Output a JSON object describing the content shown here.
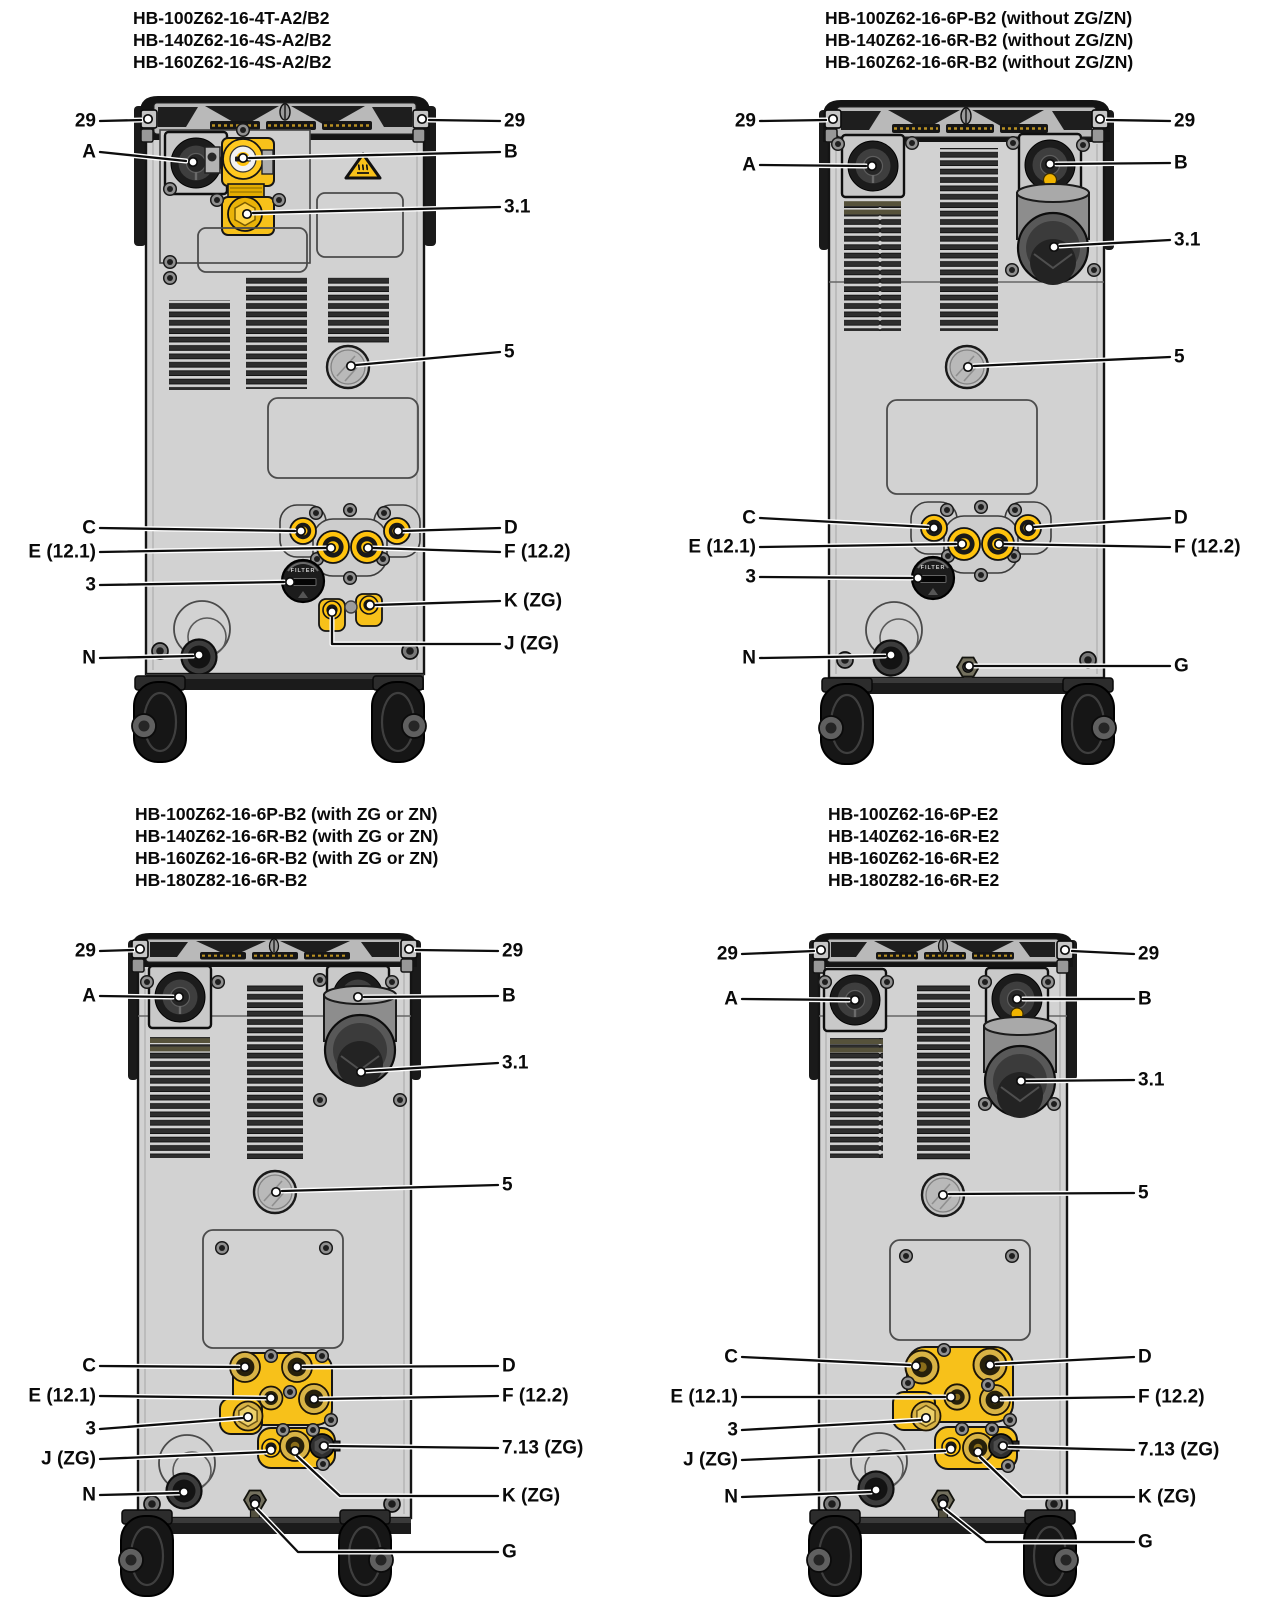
{
  "page": {
    "type": "technical-diagram",
    "background": "#ffffff"
  },
  "shared": {
    "filter_label": "FILTER",
    "colors": {
      "accent_yellow": "#f7c11a",
      "body_gray": "#d2d2d2",
      "outline": "#111111",
      "brass": "#d8b345"
    },
    "icons": {
      "warning": "hot-surface-warning-icon"
    }
  },
  "panels": [
    {
      "id": "top-left",
      "title_lines": [
        "HB-100Z62-16-4T-A2/B2",
        "HB-140Z62-16-4S-A2/B2",
        "HB-160Z62-16-4S-A2/B2"
      ],
      "callouts": {
        "n29l": "29",
        "n29r": "29",
        "a": "A",
        "b": "B",
        "v31": "3.1",
        "v5": "5",
        "c": "C",
        "d": "D",
        "e": "E (12.1)",
        "f": "F (12.2)",
        "v3": "3",
        "k": "K (ZG)",
        "j": "J (ZG)",
        "n": "N"
      }
    },
    {
      "id": "top-right",
      "title_lines": [
        "HB-100Z62-16-6P-B2 (without ZG/ZN)",
        "HB-140Z62-16-6R-B2 (without ZG/ZN)",
        "HB-160Z62-16-6R-B2 (without ZG/ZN)"
      ],
      "callouts": {
        "n29l": "29",
        "n29r": "29",
        "a": "A",
        "b": "B",
        "v31": "3.1",
        "v5": "5",
        "c": "C",
        "d": "D",
        "e": "E (12.1)",
        "f": "F (12.2)",
        "v3": "3",
        "n": "N",
        "g": "G"
      }
    },
    {
      "id": "bottom-left",
      "title_lines": [
        "HB-100Z62-16-6P-B2 (with ZG or ZN)",
        "HB-140Z62-16-6R-B2 (with ZG or ZN)",
        "HB-160Z62-16-6R-B2 (with ZG or ZN)",
        "HB-180Z82-16-6R-B2"
      ],
      "callouts": {
        "n29l": "29",
        "n29r": "29",
        "a": "A",
        "b": "B",
        "v31": "3.1",
        "v5": "5",
        "c": "C",
        "d": "D",
        "e": "E (12.1)",
        "f": "F (12.2)",
        "v3": "3",
        "j": "J (ZG)",
        "v713": "7.13 (ZG)",
        "k": "K (ZG)",
        "n": "N",
        "g": "G"
      }
    },
    {
      "id": "bottom-right",
      "title_lines": [
        "HB-100Z62-16-6P-E2",
        "HB-140Z62-16-6R-E2",
        "HB-160Z62-16-6R-E2",
        "HB-180Z82-16-6R-E2"
      ],
      "callouts": {
        "n29l": "29",
        "n29r": "29",
        "a": "A",
        "b": "B",
        "v31": "3.1",
        "v5": "5",
        "c": "C",
        "d": "D",
        "e": "E (12.1)",
        "f": "F (12.2)",
        "v3": "3",
        "j": "J (ZG)",
        "v713": "7.13 (ZG)",
        "k": "K (ZG)",
        "n": "N",
        "g": "G"
      }
    }
  ]
}
